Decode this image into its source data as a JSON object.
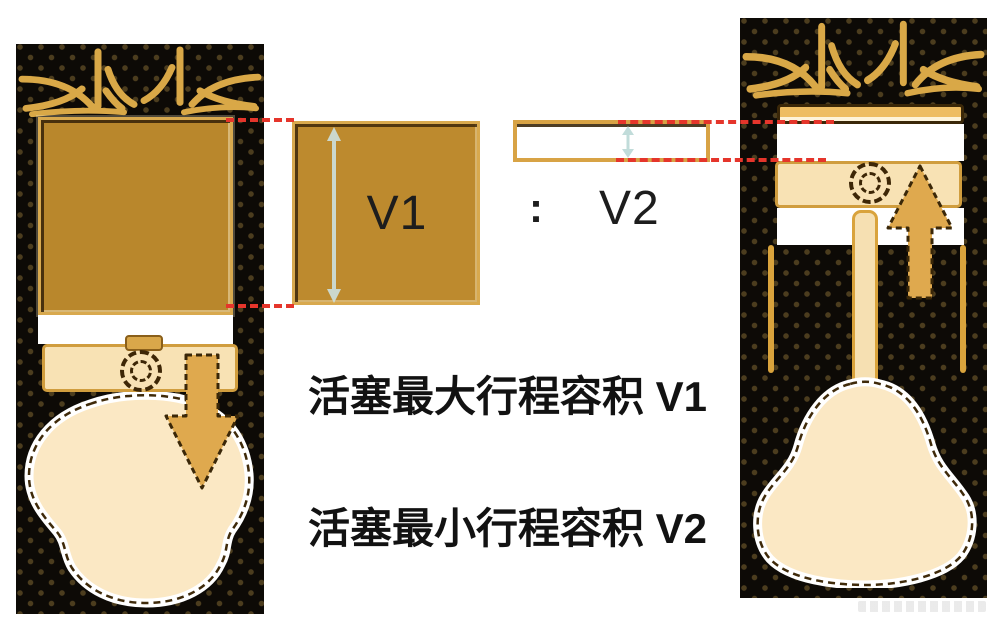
{
  "figure": {
    "v1_label": "V1",
    "v2_label": "V2",
    "ratio_colon": ":",
    "caption_max": "活塞最大行程容积 V1",
    "caption_min": "活塞最小行程容积 V2"
  },
  "colors": {
    "cylinder_body": "#0d0a06",
    "pattern_dot": "#806632",
    "gold_pipes": "#d9a847",
    "amber_volume": "#bd8a2e",
    "piston_cream": "#f8e2b4",
    "crank_cream": "#fbe8c4",
    "arrow_gold": "#dfa94e",
    "outline_dark": "#3a2708",
    "alignment_dash_red": "#e5352b",
    "measure_arrow_blue": "#cde1df",
    "label_text": "#1d1d1d"
  },
  "icons": {
    "left_piston_motion": "arrow-down",
    "right_piston_motion": "arrow-up",
    "v1_measure": "vertical-double-arrow",
    "v2_measure": "vertical-double-arrow",
    "wrist_pin": "dashed-circle"
  }
}
